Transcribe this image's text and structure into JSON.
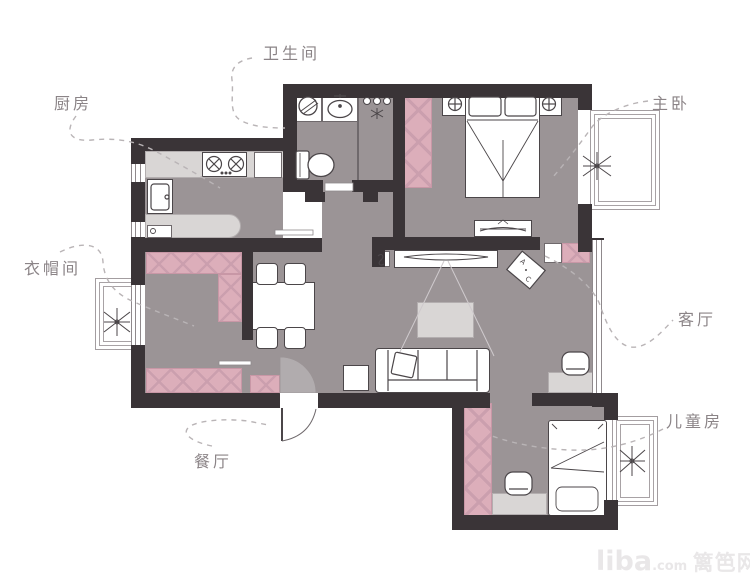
{
  "rooms": {
    "bathroom": {
      "label": "卫生间"
    },
    "kitchen": {
      "label": "厨房"
    },
    "master_bedroom": {
      "label": "主卧"
    },
    "cloakroom": {
      "label": "衣帽间"
    },
    "living_room": {
      "label": "客厅"
    },
    "dining_room": {
      "label": "餐厅"
    },
    "kids_room": {
      "label": "儿童房"
    }
  },
  "ac_unit": {
    "letter_a": "A",
    "letter_c": "C"
  },
  "watermark": {
    "brand": "liba",
    "suffix": ".com",
    "site": "篱笆网"
  },
  "colors": {
    "wall": "#3a3437",
    "floor": "#9b9496",
    "pink_furniture": "#dcaeba",
    "light_furniture": "#d9d6d5",
    "outline": "#4b4649",
    "label_text": "#8b8487",
    "leader_dash": "#b9b4b6",
    "watermark_text": "#e9e7e8"
  },
  "icons": {
    "plant": "plant-icon",
    "toilet": "toilet-icon",
    "basin": "basin-icon",
    "washing_machine": "washing-machine-icon",
    "shower": "shower-icon",
    "stove": "stove-icon",
    "kitchen_sink": "kitchen-sink-icon",
    "nightstand_lamp": "nightstand-lamp-icon",
    "tv": "tv-icon",
    "ac": "ac-unit-icon",
    "door_swing": "door-swing-arc"
  }
}
